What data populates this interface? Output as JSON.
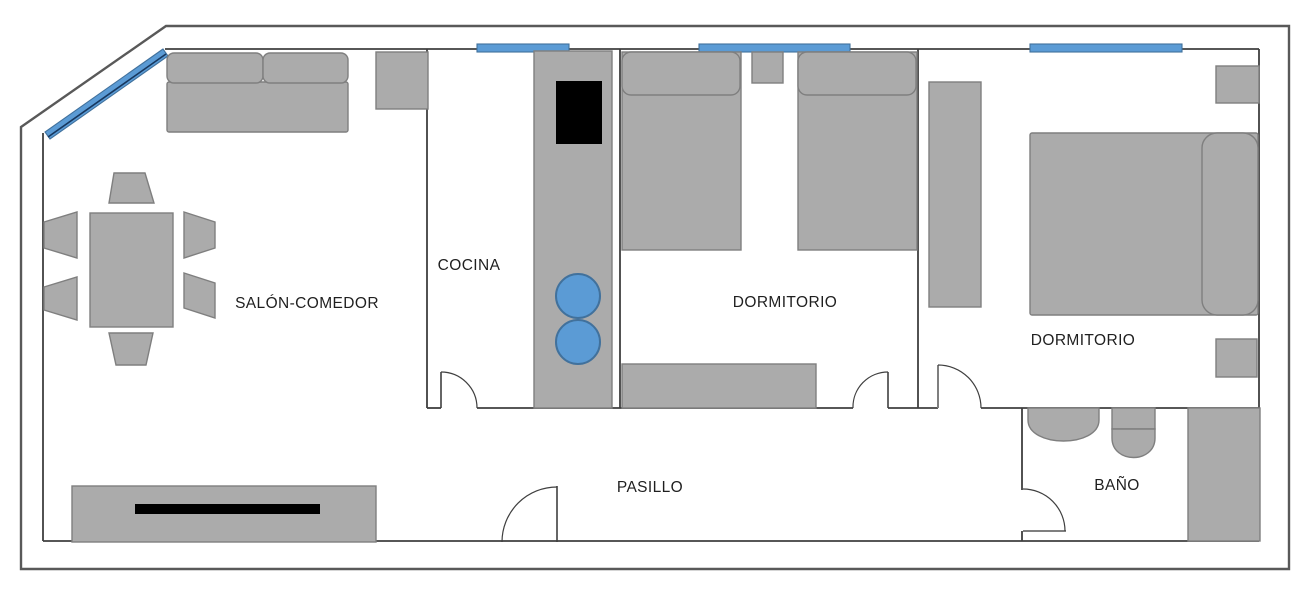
{
  "floorplan": {
    "type": "apartment-floor-plan",
    "rooms": [
      {
        "name": "salon-comedor",
        "label": "SALÓN-COMEDOR"
      },
      {
        "name": "cocina",
        "label": "COCINA"
      },
      {
        "name": "dormitorio-1",
        "label": "DORMITORIO"
      },
      {
        "name": "dormitorio-2",
        "label": "DORMITORIO"
      },
      {
        "name": "pasillo",
        "label": "PASILLO"
      },
      {
        "name": "bano",
        "label": "BAÑO"
      }
    ],
    "colors": {
      "furniture_fill": "#ABABAB",
      "furniture_border": "#7F7F7F",
      "wall": "#3F3F3F",
      "wall_outer": "#595959",
      "window_blue": "#5B9BD5",
      "window_border": "#41719C",
      "window_dark_line": "#17375E",
      "appliance_black": "#000000",
      "floor_white": "#FFFFFF",
      "label_text": "#1F1F1F"
    }
  }
}
